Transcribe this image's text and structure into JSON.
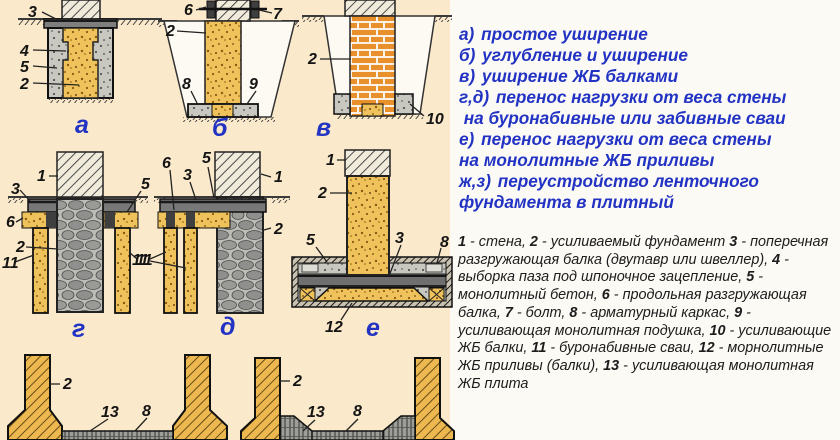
{
  "colors": {
    "left_bg": "#FAE9CA",
    "right_bg": "#FCFAF5",
    "accent_blue": "#2233C4",
    "text_black": "#1C1C1C",
    "concrete_yellow": "#F0C25C",
    "brick_orange": "#E8912C"
  },
  "methods": [
    {
      "key": "а)",
      "text": " простое уширение"
    },
    {
      "key": "б)",
      "text": " углубление и уширение"
    },
    {
      "key": "в)",
      "text": " уширение ЖБ балками"
    },
    {
      "key": "г,д)",
      "text": " перенос нагрузки от веса стены\n на буронабивные или забивные сваи"
    },
    {
      "key": "е)",
      "text": " перенос нагрузки от веса стены\nна монолитные ЖБ приливы"
    },
    {
      "key": "ж,з)",
      "text": " переустройство ленточного\nфундамента в плитный"
    }
  ],
  "legend": [
    {
      "num": "1",
      "text": " - стена, "
    },
    {
      "num": "2",
      "text": " - усиливаемый фундамент "
    },
    {
      "num": "3",
      "text": " - поперечная разгружающая балка (двутавр или швеллер), "
    },
    {
      "num": "4",
      "text": " - выборка паза под шпоночное зацепление, "
    },
    {
      "num": "5",
      "text": " - монолитный бетон, "
    },
    {
      "num": "6",
      "text": " - продольная разгружающая балка, "
    },
    {
      "num": "7",
      "text": " - болт, "
    },
    {
      "num": "8",
      "text": " - арматурный каркас, "
    },
    {
      "num": "9",
      "text": " - усиливающая монолитная подушка, "
    },
    {
      "num": "10",
      "text": " - усиливающие ЖБ балки, "
    },
    {
      "num": "11",
      "text": " - буронабивные сваи, "
    },
    {
      "num": "12",
      "text": " - морнолитные ЖБ приливы (балки), "
    },
    {
      "num": "13",
      "text": " - усиливающая монолитная ЖБ плита"
    }
  ],
  "diagrams": {
    "a": {
      "letter": "а",
      "label_3": "3",
      "label_4": "4",
      "label_5": "5",
      "label_2": "2"
    },
    "b": {
      "letter": "б",
      "label_6": "6",
      "label_7": "7",
      "label_2": "2",
      "label_8": "8",
      "label_9": "9"
    },
    "v": {
      "letter": "в",
      "label_2": "2",
      "label_10": "10"
    },
    "g": {
      "letter": "г",
      "label_1": "1",
      "label_3": "3",
      "label_5": "5",
      "label_6": "6",
      "label_2": "2",
      "label_11_left": "11",
      "label_11_right": "11"
    },
    "d": {
      "letter": "д",
      "label_1": "1",
      "label_2": "2",
      "label_3": "3",
      "label_5": "5",
      "label_6": "6",
      "label_11": "11"
    },
    "e": {
      "letter": "е",
      "label_1": "1",
      "label_2": "2",
      "label_3": "3",
      "label_5": "5",
      "label_8": "8",
      "label_12": "12"
    },
    "zh": {
      "label_2": "2",
      "label_13": "13",
      "label_8": "8"
    },
    "z": {
      "label_2": "2",
      "label_13": "13",
      "label_8": "8"
    }
  }
}
